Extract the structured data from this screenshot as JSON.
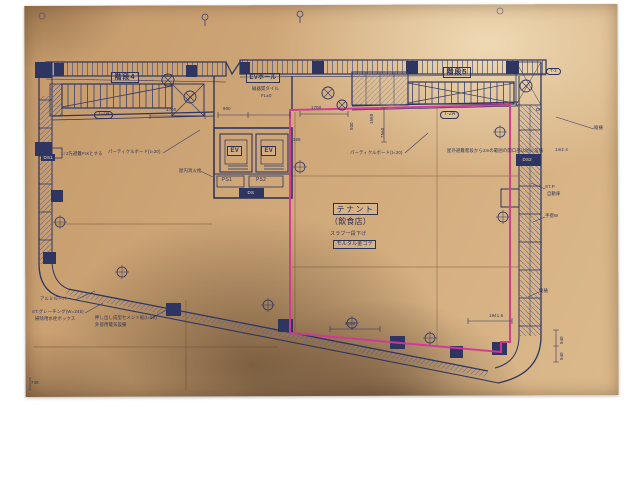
{
  "colors": {
    "paper": "#cfa778",
    "ink": "#2e3560",
    "highlight": "#d6359b"
  },
  "plan": {
    "rooms": {
      "stair4": "階段4",
      "stair5": "階段5",
      "ev_hall": "EVホール",
      "ev1": "EV",
      "ev2": "EV",
      "ps1": "PS1",
      "ps2": "PS2",
      "ds": "DS",
      "ds1": "DS1",
      "ds2": "DS2",
      "tenant_title": "テナント",
      "tenant_sub": "（飲食店）"
    },
    "tags": {
      "t2a_left": "T-2A",
      "t2a_right": "T-2A",
      "t2a_corner": "T-2"
    },
    "notes": {
      "floor_tile": "磁器質タイル",
      "floor_level": "FL±0",
      "fix": "1↑2先避難FIXとする",
      "board_left": "パーティクルボード(t=20)",
      "board_right": "パーティクルボード(t=20)",
      "hydrant": "屋内消火栓",
      "fire": "屋外避難階段から2mの範囲の開口部は防火設備",
      "df": "DF",
      "tenant_note1": "スラブ一段下げ",
      "tenant_note2": "モルタル金ゴテ",
      "louver": "アルミルーバー",
      "grating": "ST.グレーチング(W=245)",
      "faucet": "掃除用水栓ボックス",
      "cement": "押し出し成型セメント板(t=50)",
      "cement2": "外部用電気設備",
      "downspout1": "縦樋",
      "downspout2": "縦樋",
      "stp": "ST.P",
      "auto_door": "自動扉",
      "handrail": "手摺W"
    },
    "dims": {
      "a": "1700",
      "b": "900",
      "c": "1700",
      "d": "500",
      "e": "7560",
      "f": "1580",
      "g": "365",
      "h": "1941.6",
      "i": "4100",
      "j": "748",
      "k": "540",
      "l": "540",
      "m": "1m2.4"
    }
  }
}
